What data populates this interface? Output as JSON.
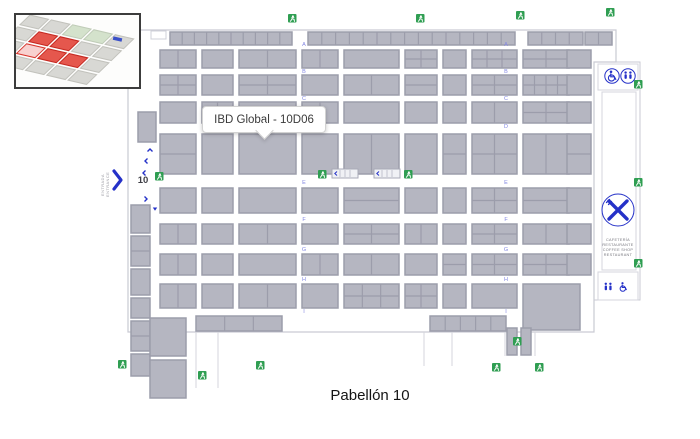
{
  "title": "Pabellón 10",
  "tooltip": {
    "text": "IBD Global - 10D06"
  },
  "entrance": {
    "number": "10",
    "lines": [
      "ENTRADA",
      "ENTRANCE"
    ]
  },
  "cafeteria": {
    "lines": [
      "CAFETERÍA",
      "RESTAURANTE",
      "COFFEE SHOP",
      "RESTAURANT"
    ]
  },
  "colors": {
    "booth": "#b5b6c1",
    "booth_border": "#9c9dab",
    "outline": "#c9cad3",
    "exit_green": "#2f9e52",
    "icon_blue": "#2531c8",
    "aisle_letter": "#8286e2",
    "highlight_red": "#e2453a",
    "inset_gray": "#d8d8d4",
    "inset_green": "#d4e2cc"
  },
  "aisles": {
    "letters": [
      "A",
      "B",
      "C",
      "D",
      "E",
      "F",
      "G",
      "H",
      "I"
    ],
    "xs": [
      304,
      506
    ],
    "ys": [
      44,
      71,
      98,
      126,
      182,
      219,
      249,
      279,
      311
    ]
  },
  "floorplan": {
    "booths": [
      [
        170,
        32,
        122,
        13,
        10,
        1
      ],
      [
        308,
        32,
        207,
        13,
        15,
        1
      ],
      [
        528,
        32,
        55,
        13,
        4,
        1
      ],
      [
        585,
        32,
        27,
        13,
        2,
        1
      ],
      [
        160,
        50,
        36,
        18,
        2,
        1
      ],
      [
        202,
        50,
        31,
        18,
        1,
        1
      ],
      [
        239,
        50,
        57,
        18,
        2,
        1
      ],
      [
        302,
        50,
        36,
        18,
        2,
        1
      ],
      [
        344,
        50,
        55,
        18,
        1,
        1
      ],
      [
        405,
        50,
        32,
        18,
        2,
        2
      ],
      [
        443,
        50,
        23,
        18,
        1,
        1
      ],
      [
        472,
        50,
        45,
        18,
        3,
        2
      ],
      [
        523,
        50,
        46,
        18,
        2,
        2
      ],
      [
        567,
        50,
        24,
        18,
        1,
        1
      ],
      [
        160,
        75,
        36,
        20,
        2,
        2
      ],
      [
        202,
        75,
        31,
        20,
        1,
        1
      ],
      [
        239,
        75,
        57,
        20,
        2,
        2
      ],
      [
        302,
        75,
        36,
        20,
        1,
        1
      ],
      [
        344,
        75,
        55,
        20,
        2,
        1
      ],
      [
        405,
        75,
        32,
        20,
        1,
        2
      ],
      [
        443,
        75,
        23,
        20,
        1,
        1
      ],
      [
        472,
        75,
        45,
        20,
        2,
        2
      ],
      [
        523,
        75,
        46,
        20,
        4,
        2
      ],
      [
        567,
        75,
        24,
        20,
        1,
        1
      ],
      [
        160,
        102,
        36,
        21,
        1,
        1
      ],
      [
        202,
        102,
        31,
        21,
        2,
        1
      ],
      [
        239,
        102,
        57,
        21,
        1,
        1
      ],
      [
        302,
        102,
        36,
        21,
        2,
        1
      ],
      [
        344,
        102,
        55,
        21,
        1,
        1
      ],
      [
        405,
        102,
        32,
        21,
        1,
        1
      ],
      [
        443,
        102,
        23,
        21,
        1,
        1
      ],
      [
        472,
        102,
        45,
        21,
        2,
        1
      ],
      [
        523,
        102,
        46,
        21,
        2,
        2
      ],
      [
        567,
        102,
        24,
        21,
        1,
        1
      ],
      [
        160,
        134,
        36,
        40,
        1,
        2
      ],
      [
        202,
        134,
        31,
        40,
        1,
        1
      ],
      [
        239,
        134,
        57,
        40,
        1,
        1
      ],
      [
        302,
        134,
        36,
        40,
        1,
        1
      ],
      [
        344,
        134,
        55,
        40,
        2,
        1
      ],
      [
        405,
        134,
        32,
        40,
        1,
        1
      ],
      [
        443,
        134,
        23,
        40,
        1,
        2
      ],
      [
        472,
        134,
        45,
        40,
        2,
        2
      ],
      [
        523,
        134,
        46,
        40,
        2,
        1
      ],
      [
        567,
        134,
        24,
        40,
        1,
        2
      ],
      [
        160,
        188,
        36,
        25,
        1,
        1
      ],
      [
        202,
        188,
        31,
        25,
        1,
        1
      ],
      [
        239,
        188,
        57,
        25,
        1,
        1
      ],
      [
        302,
        188,
        36,
        25,
        1,
        1
      ],
      [
        344,
        188,
        55,
        25,
        1,
        2
      ],
      [
        405,
        188,
        32,
        25,
        1,
        1
      ],
      [
        443,
        188,
        23,
        25,
        1,
        1
      ],
      [
        472,
        188,
        45,
        25,
        2,
        2
      ],
      [
        523,
        188,
        46,
        25,
        1,
        2
      ],
      [
        567,
        188,
        24,
        25,
        1,
        1
      ],
      [
        160,
        224,
        36,
        20,
        2,
        1
      ],
      [
        202,
        224,
        31,
        20,
        1,
        1
      ],
      [
        239,
        224,
        57,
        20,
        2,
        1
      ],
      [
        302,
        224,
        36,
        20,
        1,
        1
      ],
      [
        344,
        224,
        55,
        20,
        2,
        2
      ],
      [
        405,
        224,
        32,
        20,
        2,
        1
      ],
      [
        443,
        224,
        23,
        20,
        1,
        1
      ],
      [
        472,
        224,
        45,
        20,
        2,
        2
      ],
      [
        523,
        224,
        46,
        20,
        2,
        1
      ],
      [
        567,
        224,
        24,
        20,
        1,
        1
      ],
      [
        160,
        254,
        36,
        21,
        2,
        1
      ],
      [
        202,
        254,
        31,
        21,
        1,
        1
      ],
      [
        239,
        254,
        57,
        21,
        1,
        1
      ],
      [
        302,
        254,
        36,
        21,
        2,
        1
      ],
      [
        344,
        254,
        55,
        21,
        2,
        1
      ],
      [
        405,
        254,
        32,
        21,
        1,
        1
      ],
      [
        443,
        254,
        23,
        21,
        1,
        2
      ],
      [
        472,
        254,
        45,
        21,
        2,
        2
      ],
      [
        523,
        254,
        46,
        21,
        2,
        2
      ],
      [
        567,
        254,
        24,
        21,
        1,
        1
      ],
      [
        160,
        284,
        36,
        24,
        2,
        1
      ],
      [
        202,
        284,
        31,
        24,
        1,
        1
      ],
      [
        239,
        284,
        57,
        24,
        2,
        1
      ],
      [
        302,
        284,
        36,
        24,
        1,
        1
      ],
      [
        344,
        284,
        55,
        24,
        3,
        2
      ],
      [
        405,
        284,
        32,
        24,
        2,
        2
      ],
      [
        443,
        284,
        23,
        24,
        1,
        1
      ],
      [
        472,
        284,
        45,
        24,
        1,
        1
      ],
      [
        523,
        284,
        57,
        46,
        1,
        1
      ],
      [
        196,
        316,
        86,
        15,
        3,
        1
      ],
      [
        430,
        316,
        76,
        15,
        5,
        1
      ],
      [
        507,
        328,
        10,
        27,
        1,
        1
      ],
      [
        521,
        328,
        10,
        27,
        1,
        1
      ],
      [
        138,
        112,
        18,
        30,
        1,
        1
      ],
      [
        131,
        205,
        19,
        28,
        1,
        1
      ],
      [
        131,
        236,
        19,
        30,
        1,
        2
      ],
      [
        131,
        269,
        19,
        26,
        1,
        1
      ],
      [
        131,
        298,
        19,
        20,
        1,
        1
      ],
      [
        131,
        321,
        19,
        30,
        1,
        2
      ],
      [
        131,
        354,
        19,
        22,
        1,
        1
      ],
      [
        150,
        318,
        36,
        38,
        1,
        1
      ],
      [
        150,
        360,
        36,
        38,
        1,
        1
      ]
    ],
    "exits": [
      [
        288,
        14
      ],
      [
        416,
        14
      ],
      [
        516,
        11
      ],
      [
        606,
        8
      ],
      [
        155,
        172
      ],
      [
        318,
        170
      ],
      [
        404,
        170
      ],
      [
        634,
        80
      ],
      [
        634,
        178
      ],
      [
        634,
        259
      ],
      [
        513,
        337
      ],
      [
        492,
        363
      ],
      [
        535,
        363
      ],
      [
        256,
        361
      ],
      [
        198,
        371
      ],
      [
        118,
        360
      ]
    ],
    "escalators": [
      [
        332,
        169
      ],
      [
        374,
        169
      ]
    ]
  },
  "inset": {
    "cells": [
      [
        0,
        0,
        0
      ],
      [
        0,
        1,
        0
      ],
      [
        0,
        2,
        3
      ],
      [
        0,
        3,
        3
      ],
      [
        0,
        4,
        0
      ],
      [
        1,
        0,
        0
      ],
      [
        1,
        1,
        1
      ],
      [
        1,
        2,
        1
      ],
      [
        1,
        3,
        0
      ],
      [
        1,
        4,
        0
      ],
      [
        2,
        0,
        0
      ],
      [
        2,
        1,
        2
      ],
      [
        2,
        2,
        1
      ],
      [
        2,
        3,
        1
      ],
      [
        2,
        4,
        0
      ],
      [
        3,
        0,
        0
      ],
      [
        3,
        1,
        0
      ],
      [
        3,
        2,
        0
      ],
      [
        3,
        3,
        0
      ],
      [
        3,
        4,
        0
      ]
    ]
  }
}
